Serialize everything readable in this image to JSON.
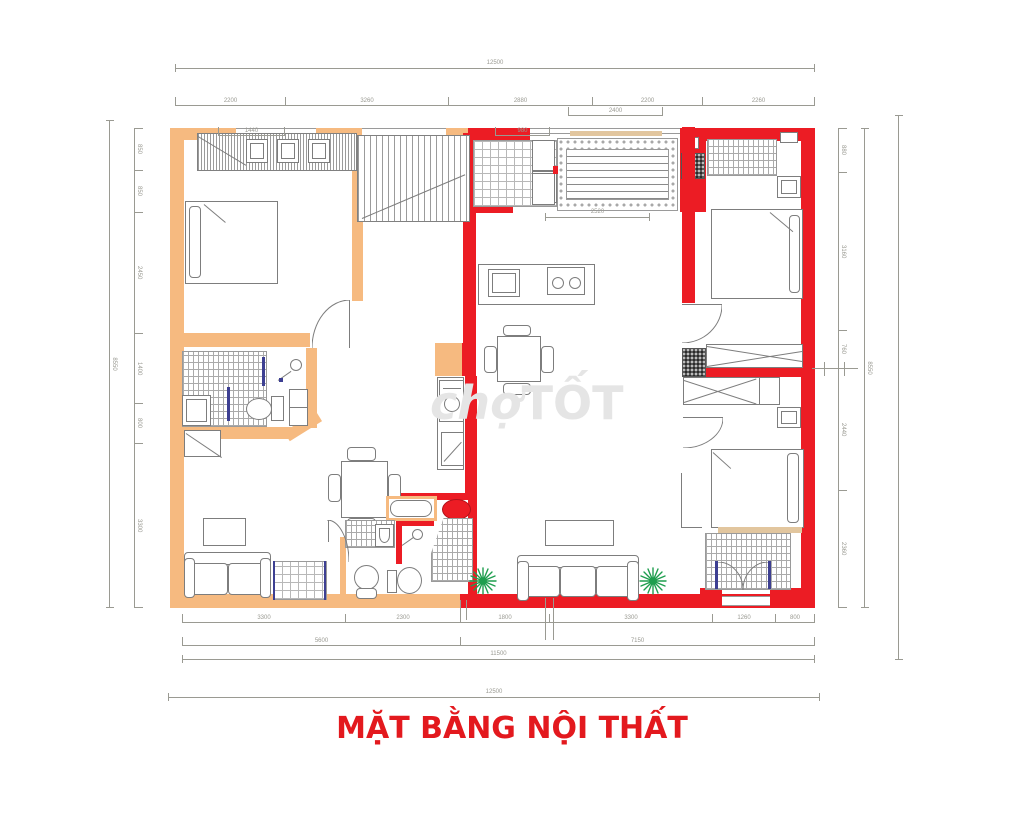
{
  "title": {
    "text": "MẶT BẰNG NỘI THẤT"
  },
  "watermark": {
    "part1": "chợ",
    "part2": "TỐT"
  },
  "colors": {
    "wall_orange": "#F6BA80",
    "wall_red": "#EC1C24",
    "accent_tan": "#E2C69E",
    "line_gray": "#7D7D7D",
    "dim_gray": "#9A9A92",
    "title_red": "#E3191E",
    "door_navy": "#3D3F92",
    "plant_green": "#1E9E4E",
    "basin_red": "#E3191E"
  },
  "dimensions": {
    "top_overall": "12500",
    "top_row": [
      "2200",
      "3260",
      "2880",
      "2200",
      "2260"
    ],
    "top_sub_a": "1440",
    "top_sub_b": "980",
    "balcony_width": "2400",
    "balcony_inner": "2520",
    "left_overall": "8550",
    "left_row": [
      "850",
      "850",
      "2450",
      "1400",
      "800",
      "3300"
    ],
    "right_row": [
      "880",
      "3160",
      "760",
      "2440",
      "2360"
    ],
    "right_overall": "8550",
    "bottom_row": [
      "3300",
      "2300",
      "1800",
      "3300",
      "1260",
      "800"
    ],
    "bottom_row2": [
      "5600",
      "7150"
    ],
    "bottom_overall": "11500",
    "bottom_outer": "12500"
  }
}
